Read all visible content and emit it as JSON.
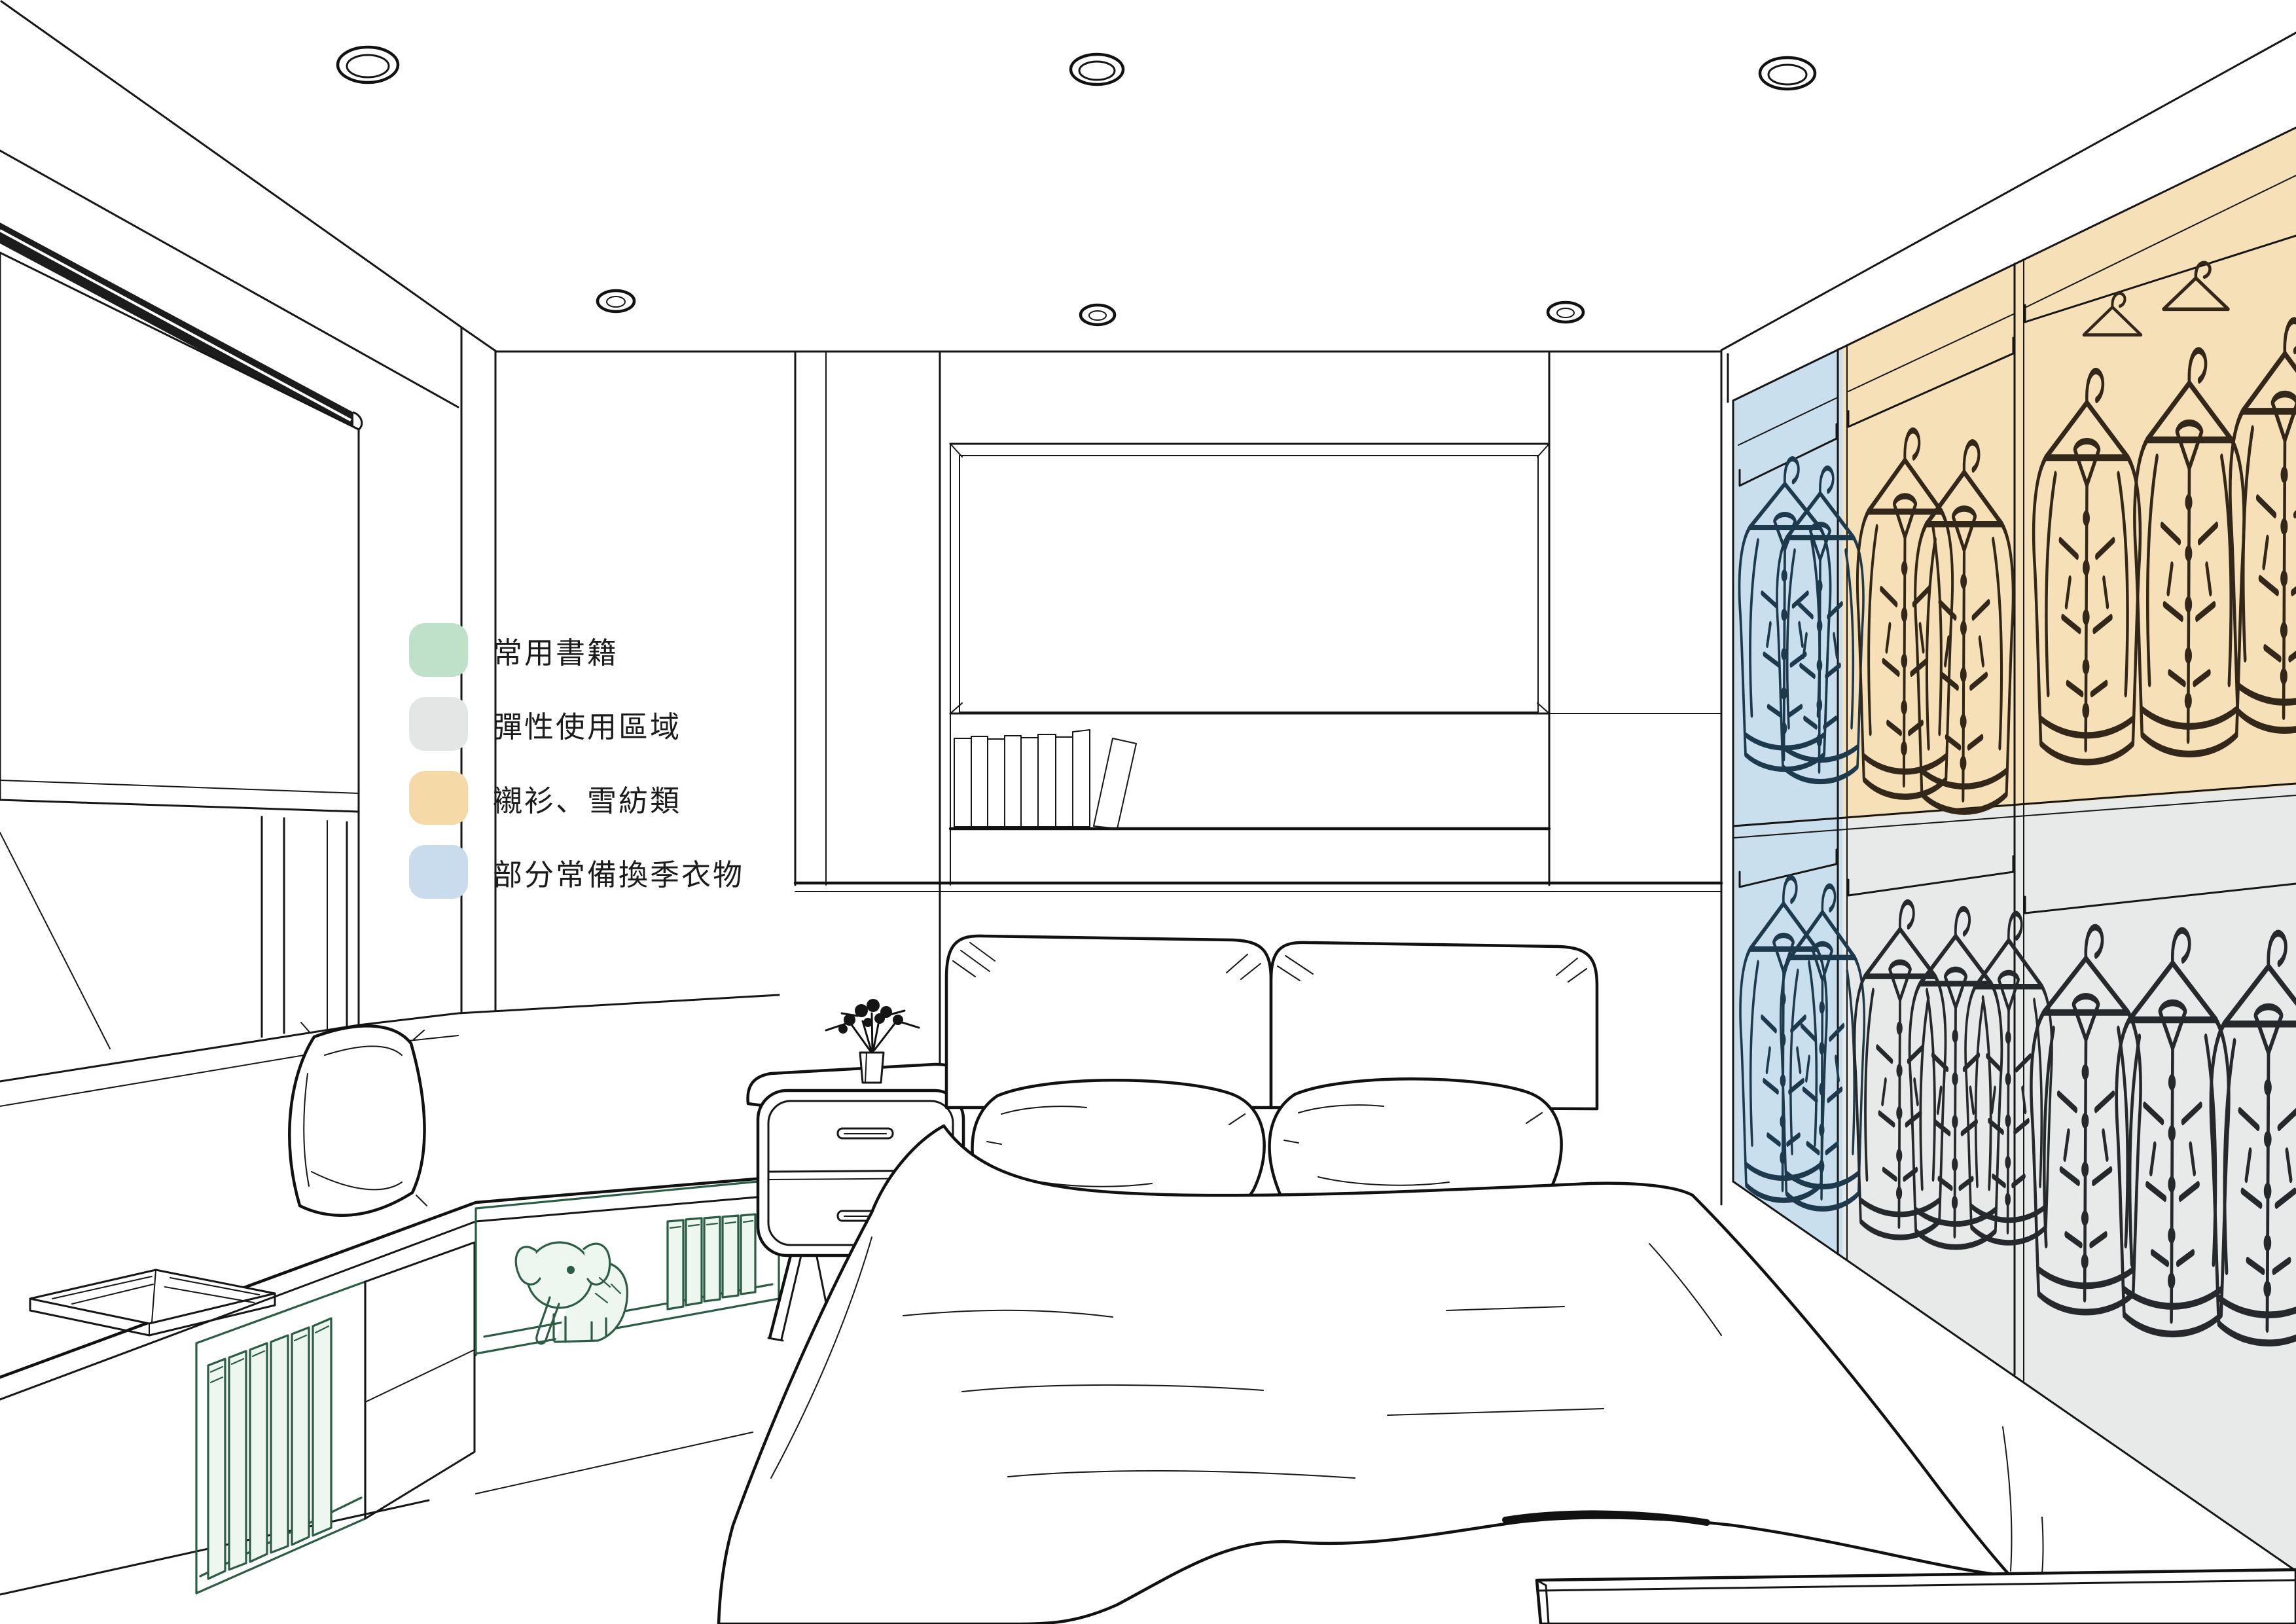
{
  "title": "bedroom storage zoning perspective sketch",
  "legend": {
    "items": [
      {
        "label": "常用書籍",
        "color": "#bfe0c9",
        "zone": "frequently-used-books"
      },
      {
        "label": "彈性使用區域",
        "color": "#e4e6e5",
        "zone": "flexible-use-area"
      },
      {
        "label": "襯衫、雪紡類",
        "color": "#f5d9a7",
        "zone": "shirts-chiffon"
      },
      {
        "label": "部分常備換季衣物",
        "color": "#c8dcee",
        "zone": "seasonal-clothes"
      }
    ]
  },
  "overlay_colors": {
    "green_fill": "#d9ecdd",
    "gray_fill": "#e8eaea",
    "orange_fill": "#f6e0b8",
    "blue_fill": "#cadfee"
  },
  "scene_objects": {
    "ceiling_lights": 6,
    "hanging_shirt_rows": 2,
    "wardrobe_columns": 3
  }
}
